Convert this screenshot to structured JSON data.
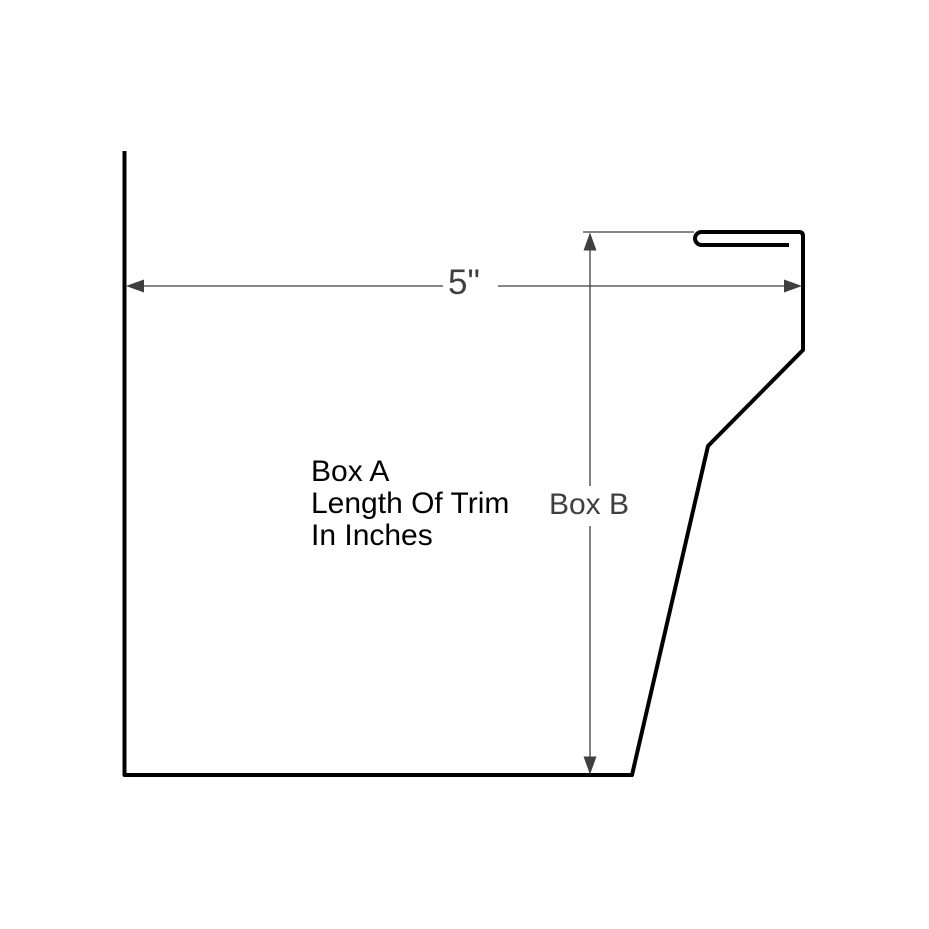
{
  "diagram": {
    "note_lines": [
      "Box A",
      "Length Of Trim",
      "In Inches"
    ],
    "width_label": "5\"",
    "height_label": "Box B",
    "colors": {
      "background": "#ffffff",
      "profile_line": "#000000",
      "dimension_line": "#3f3f3f",
      "dimension_text": "#3f3f3f",
      "note_text": "#000000"
    }
  }
}
